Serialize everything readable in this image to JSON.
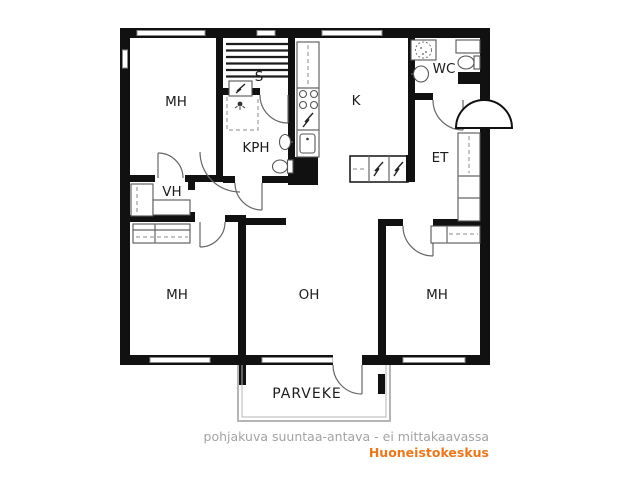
{
  "floorplan": {
    "type": "apartment-floor-plan",
    "rooms": {
      "bedroom1": {
        "label": "MH",
        "meaning": "makuuhuone / bedroom (top-left)"
      },
      "sauna": {
        "label": "S",
        "meaning": "sauna"
      },
      "bathroom": {
        "label": "KPH",
        "meaning": "kylpyhuone / bathroom"
      },
      "kitchen": {
        "label": "K",
        "meaning": "keittiö / kitchen"
      },
      "wc": {
        "label": "WC",
        "meaning": "toilet"
      },
      "entry": {
        "label": "ET",
        "meaning": "eteinen / entry hall"
      },
      "closet": {
        "label": "VH",
        "meaning": "vaatehuone / walk-in closet"
      },
      "bedroom2": {
        "label": "MH",
        "meaning": "makuuhuone / bedroom (bottom-left)"
      },
      "living": {
        "label": "OH",
        "meaning": "olohuone / living room"
      },
      "bedroom3": {
        "label": "MH",
        "meaning": "makuuhuone / bedroom (bottom-right)"
      },
      "balcony": {
        "label": "PARVEKE",
        "meaning": "balcony"
      }
    },
    "fixtures": [
      "sauna-benches",
      "sauna-stove",
      "shower-head",
      "shower-area-dashed",
      "washbasin",
      "toilet",
      "kitchen-counter",
      "stove-burners",
      "kitchen-sink",
      "fridge-freezer-cabinet",
      "wc-shower-cabin",
      "wc-washbasin",
      "wc-toilet",
      "wc-cabinet",
      "entry-wardrobe",
      "bedroom2-wardrobe",
      "bedroom3-wardrobe",
      "closet-wardrobes",
      "entrance-door-canopy",
      "balcony-railing"
    ],
    "colors": {
      "wall": "#111111",
      "fixture_line": "#555555",
      "railing": "#b5b5b5"
    }
  },
  "footer": {
    "disclaimer": "pohjakuva suuntaa-antava - ei mittakaavassa",
    "disclaimer_color": "#a3a3a3",
    "brand": "Huoneistokeskus",
    "brand_color": "#e8781e"
  }
}
